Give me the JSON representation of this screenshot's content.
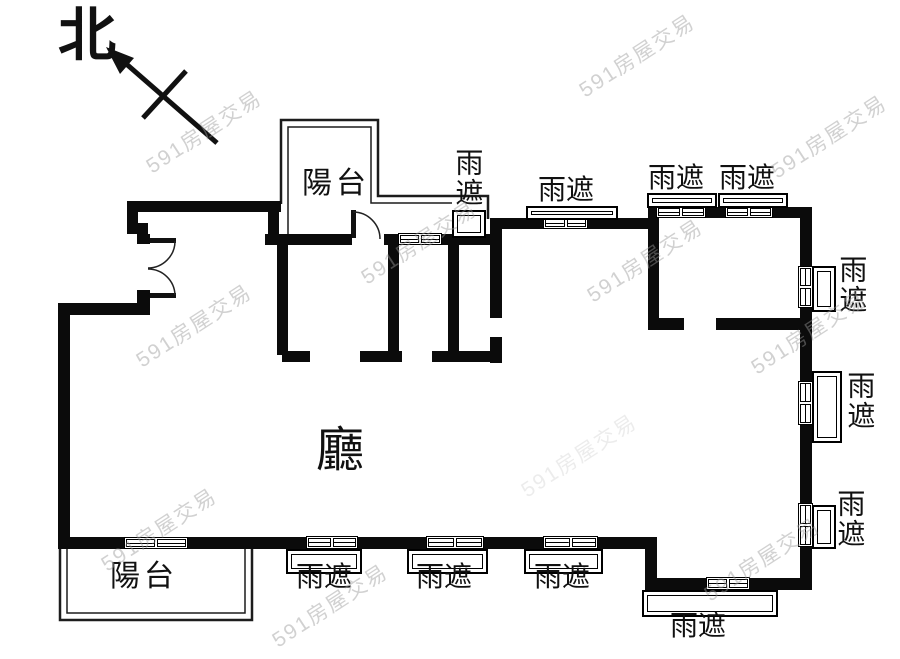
{
  "compass": {
    "north_label": "北"
  },
  "watermark": {
    "text": "591房屋交易",
    "color": "#9a9a9a"
  },
  "rooms": {
    "hall": {
      "label": "廳"
    },
    "balcony_top": {
      "label": "陽台"
    },
    "balcony_bottom": {
      "label": "陽台"
    }
  },
  "canopies": [
    {
      "position": "top-near-balcony",
      "label": "雨遮",
      "orientation": "vertical"
    },
    {
      "position": "top-middle",
      "label": "雨遮",
      "orientation": "horizontal"
    },
    {
      "position": "top-right-left",
      "label": "雨遮",
      "orientation": "horizontal"
    },
    {
      "position": "top-right-right",
      "label": "雨遮",
      "orientation": "horizontal"
    },
    {
      "position": "right-upper",
      "label": "雨遮",
      "orientation": "vertical"
    },
    {
      "position": "right-middle",
      "label": "雨遮",
      "orientation": "vertical"
    },
    {
      "position": "right-lower",
      "label": "雨遮",
      "orientation": "vertical"
    },
    {
      "position": "bottom-left",
      "label": "雨遮",
      "orientation": "horizontal"
    },
    {
      "position": "bottom-middle",
      "label": "雨遮",
      "orientation": "horizontal"
    },
    {
      "position": "bottom-right-inner",
      "label": "雨遮",
      "orientation": "horizontal"
    },
    {
      "position": "bottom-right-outer",
      "label": "雨遮",
      "orientation": "horizontal"
    }
  ],
  "colors": {
    "wall": "#0b0b0b",
    "line": "#1c1c1c",
    "background": "#ffffff"
  }
}
